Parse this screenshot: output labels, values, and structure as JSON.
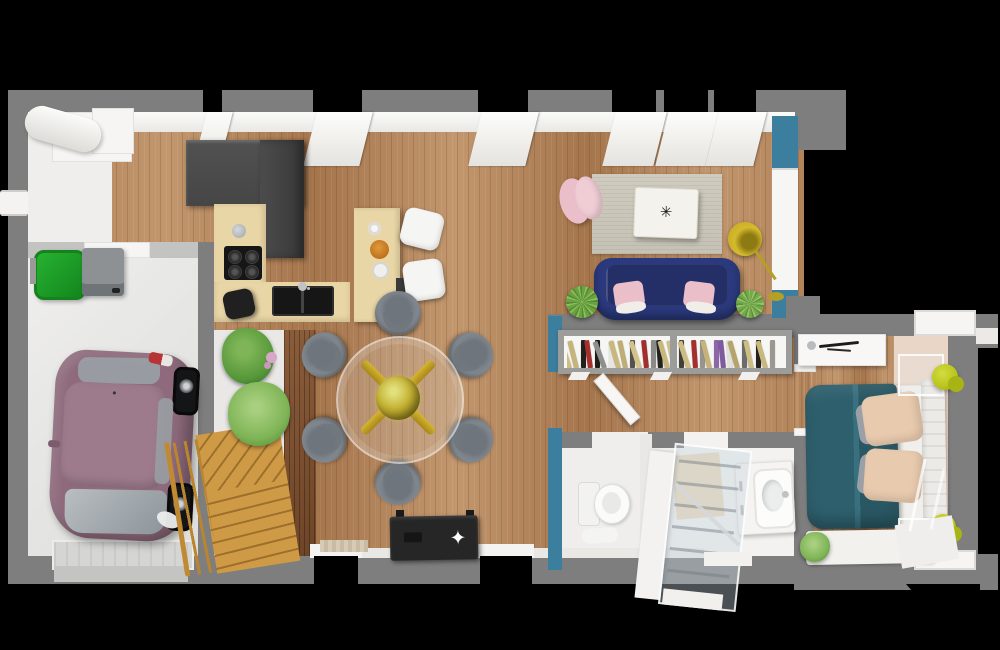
{
  "scene": {
    "description": "3D rendered top-down floor plan of a house on black background",
    "rooms": [
      "garage",
      "entry",
      "kitchen",
      "dining-area",
      "living-room",
      "hallway",
      "wc",
      "bathroom",
      "bedroom",
      "stairs-nook"
    ],
    "visible_text": null
  },
  "palette": {
    "bg": "#000000",
    "wall": "#7e7e7e",
    "wallLight": "#c3c3c1",
    "woodA": "#b2835a",
    "woodB": "#c2976e",
    "woodC": "#a5754c",
    "woodDarkA": "#8a5c3a",
    "woodDarkB": "#6e4527",
    "garageFloor": "#e7e7e5",
    "entryFloor": "#efeeec",
    "accentBlue": "#3c7e9d",
    "navy": "#2b3a7e",
    "navySeat": "#232f66",
    "pink": "#eabfc9",
    "pinkLight": "#f0cdd5",
    "rugA": "#cfcbbf",
    "rugB": "#c5c1b4",
    "marble": "#f4f2ec",
    "gold": "#c9a82c",
    "goldDeep": "#a8871a",
    "counter": "#e9d6a6",
    "cabinet": "#464646",
    "cabinetDeep": "#383838",
    "cooktop": "#161616",
    "chair": "#8a9198",
    "chairDeep": "#6e757c",
    "stoolWhite": "#f5f5f3",
    "stoolBlack": "#202020",
    "stairWood": "#cf9a46",
    "stairGap": "#9e702c",
    "rail": "#b9852f",
    "carBody": "#8e6a7c",
    "carRoof": "#9d7b8d",
    "carGlass": "#9aa1a6",
    "bin": "#1f9b28",
    "bench": "#8d9194",
    "bedTeal": "#2d5f6d",
    "bedTealHi": "#38707e",
    "mattress": "#f1efeb",
    "pillowBeige": "#e8caae",
    "pillowGray": "#9aa0a6",
    "carpet": "#ead6c6",
    "lampYellow": "#b9c41c",
    "plant": "#55973a",
    "plantHi": "#7fb557",
    "fern": "#7fb457",
    "bathMat": "#ead9bc",
    "doormatA": "#d8cbb4",
    "doormatB": "#c9bca6",
    "tv": "#262626",
    "glass": "rgba(198,211,220,0.38)"
  },
  "bookshelf": {
    "sections": 2,
    "spines": [
      [
        "#cdbd85",
        -18
      ],
      [
        "#c6b47a",
        -14
      ],
      [
        "#22201d",
        0
      ],
      [
        "#a52f2c",
        -8
      ],
      [
        "#1e1c19",
        0
      ],
      [
        "#8f8f8d",
        -20
      ],
      [
        "#e8e6e2",
        0
      ],
      [
        "#c9b87e",
        -16
      ],
      [
        "#bfae74",
        -12
      ],
      [
        "#55524e",
        0
      ],
      [
        "#d3c38a",
        -18
      ],
      [
        "#a0302e",
        -6
      ],
      [
        "#8a8a88",
        0
      ],
      [
        "#23211e",
        -4
      ],
      [
        "#c9b87e",
        -16
      ],
      [
        "#d0c086",
        -12
      ],
      [
        "#423f3b",
        0
      ],
      [
        "#cdbd85",
        -18
      ],
      [
        "#a52f2c",
        -4
      ],
      [
        "#96948f",
        0
      ],
      [
        "#c5b378",
        -14
      ],
      [
        "#8c66a8",
        0
      ],
      [
        "#7d5b9e",
        -6
      ],
      [
        "#e3e1dd",
        -4
      ],
      [
        "#b5a46c",
        -16
      ],
      [
        "#6e6c68",
        0
      ],
      [
        "#cdbd85",
        -12
      ],
      [
        "#23211e",
        0
      ],
      [
        "#c9b87e",
        -16
      ],
      [
        "#9a988f",
        0
      ]
    ]
  },
  "dining": {
    "chair_count": 6
  },
  "kitchen": {
    "burner_count": 4
  },
  "bedroom": {
    "lamp_count": 2,
    "nightstand_count": 2
  }
}
